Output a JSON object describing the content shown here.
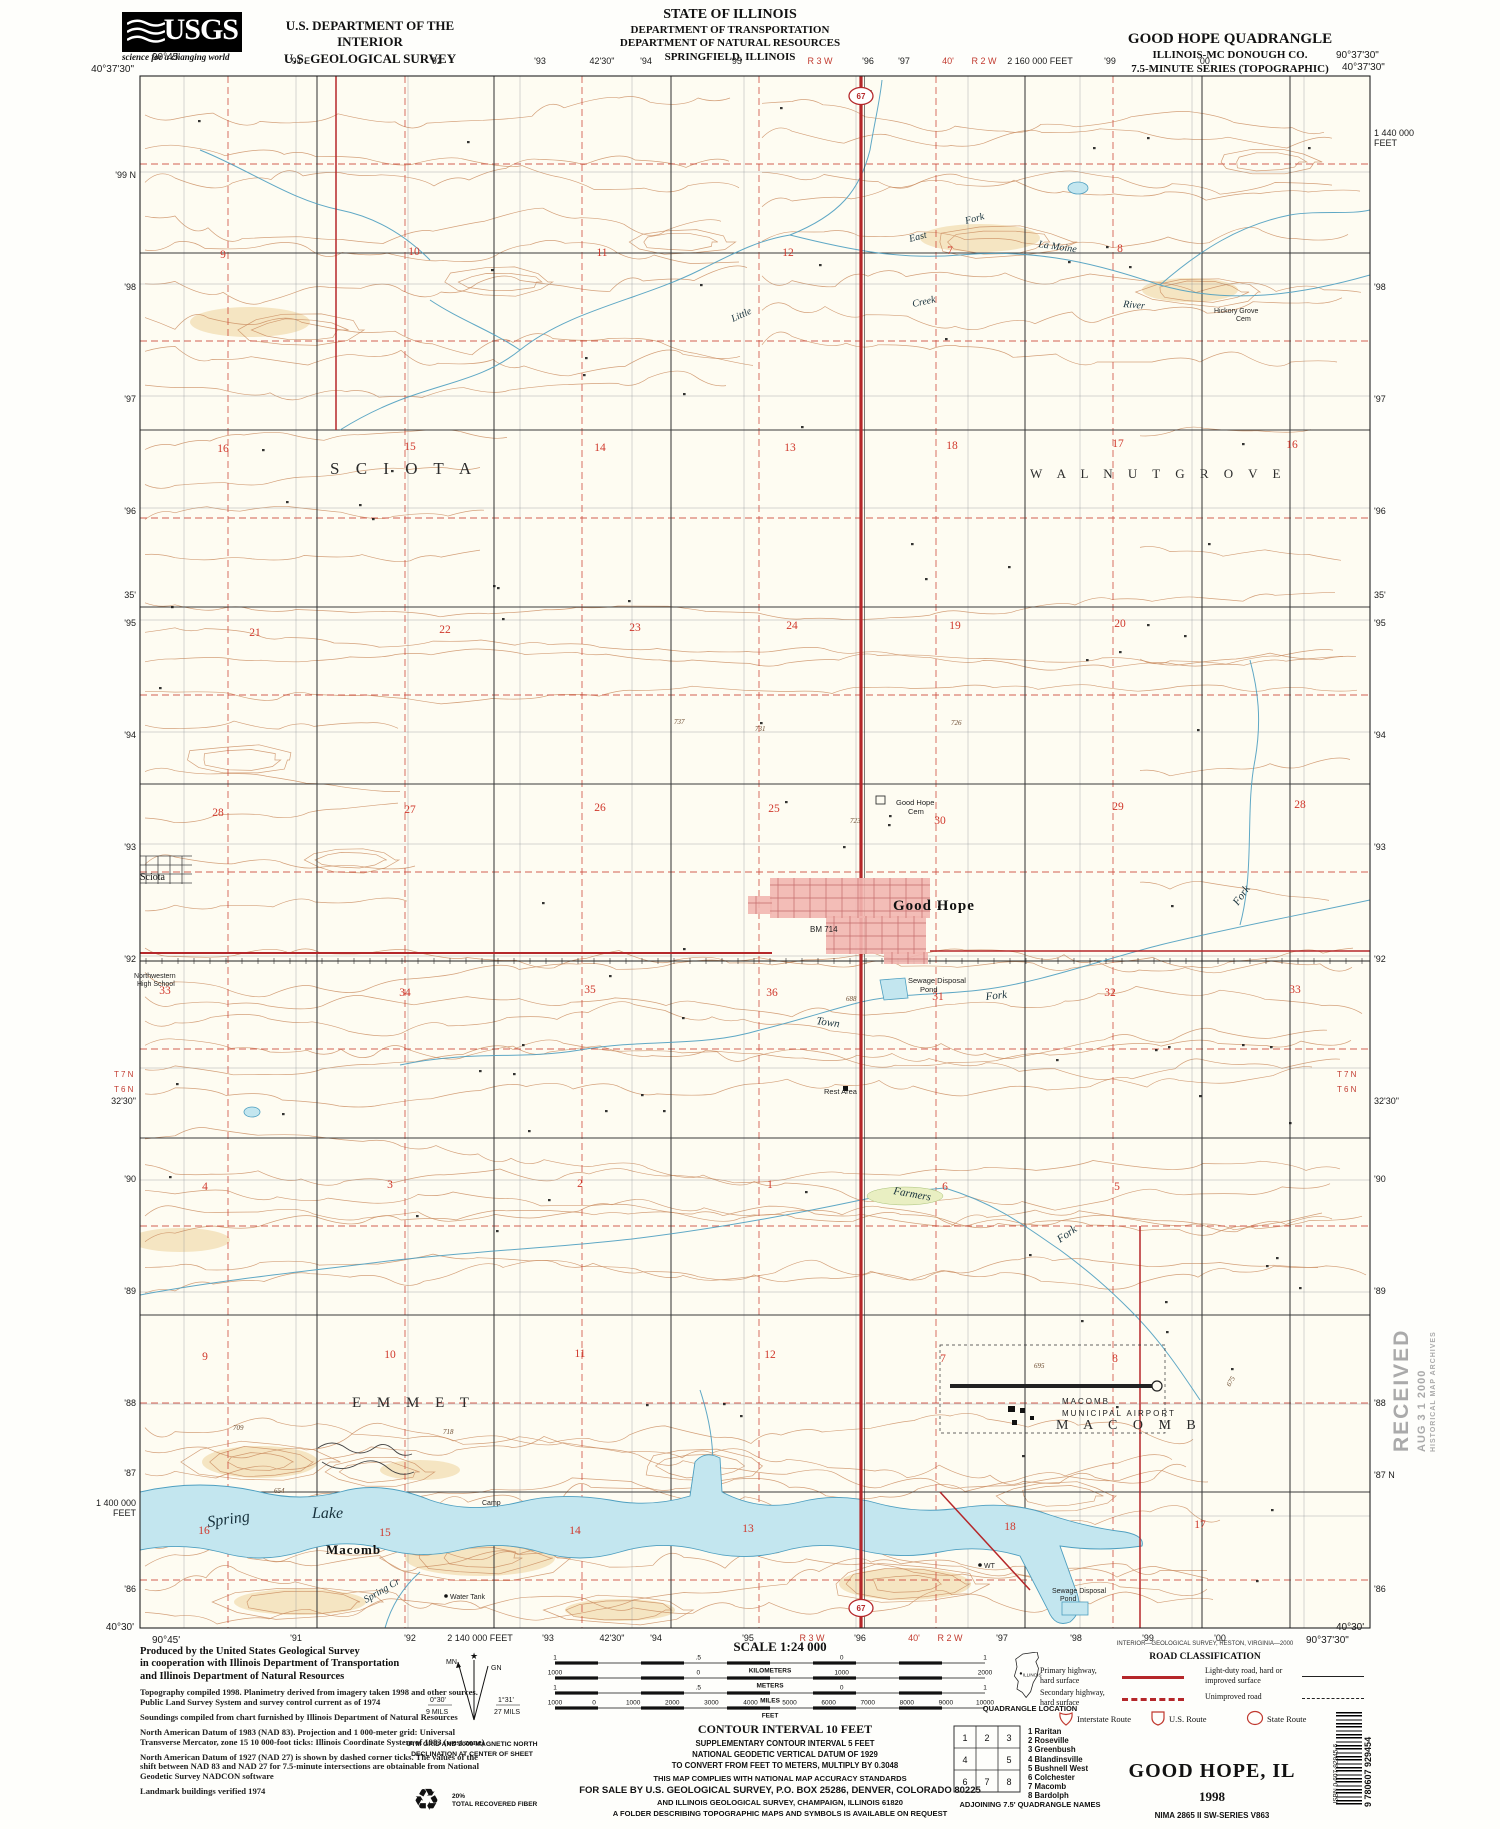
{
  "colors": {
    "primary_road": "#b5272a",
    "water_fill": "#c3e6ef",
    "water_line": "#4e9fc0",
    "contour": "#c9895c",
    "town_fill": "#f2b6b0",
    "section_red": "#d0382c"
  },
  "header": {
    "usgs": "USGS",
    "usgs_tagline": "science for a changing world",
    "agency_line1": "U.S. DEPARTMENT OF THE INTERIOR",
    "agency_line2": "U.S. GEOLOGICAL SURVEY",
    "state1": "STATE OF ILLINOIS",
    "state2": "DEPARTMENT OF TRANSPORTATION",
    "state3": "DEPARTMENT OF NATURAL RESOURCES",
    "state4": "SPRINGFIELD, ILLINOIS",
    "quad1": "GOOD HOPE QUADRANGLE",
    "quad2": "ILLINOIS-MC DONOUGH CO.",
    "quad3": "7.5-MINUTE SERIES (TOPOGRAPHIC)"
  },
  "map": {
    "corners": [
      {
        "t": "90°45'",
        "x": 152,
        "y": 60
      },
      {
        "t": "40°37'30\"",
        "x": 134,
        "y": 72,
        "a": "end"
      },
      {
        "t": "90°37'30\"",
        "x": 1336,
        "y": 58
      },
      {
        "t": "40°37'30\"",
        "x": 1342,
        "y": 70
      },
      {
        "t": "40°30'",
        "x": 134,
        "y": 1630,
        "a": "end"
      },
      {
        "t": "90°45'",
        "x": 152,
        "y": 1643
      },
      {
        "t": "40°30'",
        "x": 1336,
        "y": 1630
      },
      {
        "t": "90°37'30\"",
        "x": 1306,
        "y": 1643
      }
    ],
    "top_margin": [
      {
        "t": "'91 E",
        "x": 300
      },
      {
        "t": "'92",
        "x": 436
      },
      {
        "t": "'93",
        "x": 540
      },
      {
        "t": "42'30\"",
        "x": 602
      },
      {
        "t": "'94",
        "x": 646
      },
      {
        "t": "'95",
        "x": 736
      },
      {
        "t": "R 3 W",
        "x": 820,
        "c": "r"
      },
      {
        "t": "'96",
        "x": 868
      },
      {
        "t": "'97",
        "x": 904
      },
      {
        "t": "40'",
        "x": 948,
        "c": "r"
      },
      {
        "t": "R 2 W",
        "x": 984,
        "c": "r"
      },
      {
        "t": "2 160 000 FEET",
        "x": 1040,
        "s": 7.5
      },
      {
        "t": "'99",
        "x": 1110
      },
      {
        "t": "'00",
        "x": 1204
      }
    ],
    "bottom_margin": [
      {
        "t": "'91",
        "x": 296
      },
      {
        "t": "'92",
        "x": 410
      },
      {
        "t": "2 140 000 FEET",
        "x": 480,
        "s": 7.5
      },
      {
        "t": "'93",
        "x": 548
      },
      {
        "t": "42'30\"",
        "x": 612
      },
      {
        "t": "'94",
        "x": 656
      },
      {
        "t": "'95",
        "x": 748
      },
      {
        "t": "R 3 W",
        "x": 812,
        "c": "r"
      },
      {
        "t": "'96",
        "x": 860
      },
      {
        "t": "40'",
        "x": 914,
        "c": "r"
      },
      {
        "t": "R 2 W",
        "x": 950,
        "c": "r"
      },
      {
        "t": "'97",
        "x": 1002
      },
      {
        "t": "'98",
        "x": 1076
      },
      {
        "t": "'99",
        "x": 1148
      },
      {
        "t": "'00",
        "x": 1220
      }
    ],
    "left_margin": [
      {
        "t": "'99 N",
        "y": 178
      },
      {
        "t": "'98",
        "y": 290
      },
      {
        "t": "'97",
        "y": 402
      },
      {
        "t": "'96",
        "y": 514
      },
      {
        "t": "35'",
        "y": 598
      },
      {
        "t": "'95",
        "y": 626
      },
      {
        "t": "'94",
        "y": 738
      },
      {
        "t": "'93",
        "y": 850
      },
      {
        "t": "'92",
        "y": 962
      },
      {
        "t": "32'30\"",
        "y": 1104
      },
      {
        "t": "'90",
        "y": 1182
      },
      {
        "t": "'89",
        "y": 1294
      },
      {
        "t": "'88",
        "y": 1406
      },
      {
        "t": "'87",
        "y": 1476
      },
      {
        "t": "1 400 000",
        "y": 1506,
        "s": 7
      },
      {
        "t": "FEET",
        "y": 1516,
        "s": 7
      },
      {
        "t": "'86",
        "y": 1592
      }
    ],
    "right_margin": [
      {
        "t": "1 440 000",
        "y": 136,
        "s": 7
      },
      {
        "t": "FEET",
        "y": 146,
        "s": 7
      },
      {
        "t": "'98",
        "y": 290
      },
      {
        "t": "'97",
        "y": 402
      },
      {
        "t": "'96",
        "y": 514
      },
      {
        "t": "35'",
        "y": 598
      },
      {
        "t": "'95",
        "y": 626
      },
      {
        "t": "'94",
        "y": 738
      },
      {
        "t": "'93",
        "y": 850
      },
      {
        "t": "'92",
        "y": 962
      },
      {
        "t": "32'30\"",
        "y": 1104
      },
      {
        "t": "'90",
        "y": 1182
      },
      {
        "t": "'89",
        "y": 1294
      },
      {
        "t": "'88",
        "y": 1406
      },
      {
        "t": "'87 N",
        "y": 1478
      },
      {
        "t": "'86",
        "y": 1592
      }
    ],
    "labels": [
      {
        "t": "S C I O T A",
        "x": 330,
        "y": 474,
        "c": "twp",
        "s": 17
      },
      {
        "t": "W A L N U T   G R O V E",
        "x": 1030,
        "y": 478,
        "c": "twp",
        "s": 13
      },
      {
        "t": "E M M E T",
        "x": 352,
        "y": 1407,
        "c": "twp",
        "s": 15
      },
      {
        "t": "M A C O M B",
        "x": 1056,
        "y": 1429,
        "c": "twp",
        "s": 14
      },
      {
        "t": "Good Hope",
        "x": 893,
        "y": 910,
        "c": "town",
        "s": 15
      },
      {
        "t": "Sciota",
        "x": 140,
        "y": 880,
        "c": "ham",
        "s": 10
      },
      {
        "t": "Macomb",
        "x": 326,
        "y": 1554,
        "c": "town",
        "s": 13
      },
      {
        "t": "Spring",
        "x": 208,
        "y": 1527,
        "c": "wat",
        "s": 16,
        "r": -8
      },
      {
        "t": "Lake",
        "x": 312,
        "y": 1518,
        "c": "wat",
        "s": 16
      },
      {
        "t": "Little",
        "x": 733,
        "y": 322,
        "c": "wat",
        "s": 10,
        "r": -25
      },
      {
        "t": "East",
        "x": 910,
        "y": 242,
        "c": "wat",
        "s": 10,
        "r": -15
      },
      {
        "t": "Fork",
        "x": 966,
        "y": 224,
        "c": "wat",
        "s": 10,
        "r": -15
      },
      {
        "t": "La Moine",
        "x": 1038,
        "y": 247,
        "c": "wat",
        "s": 10,
        "r": 8
      },
      {
        "t": "Creek",
        "x": 913,
        "y": 307,
        "c": "wat",
        "s": 10,
        "r": -12
      },
      {
        "t": "River",
        "x": 1123,
        "y": 307,
        "c": "wat",
        "s": 10,
        "r": 5
      },
      {
        "t": "Hickory Grove",
        "x": 1214,
        "y": 313,
        "c": "ft",
        "s": 7
      },
      {
        "t": "Cem",
        "x": 1236,
        "y": 321,
        "c": "ft",
        "s": 7
      },
      {
        "t": "Town",
        "x": 816,
        "y": 1024,
        "c": "wat",
        "s": 11,
        "r": 8
      },
      {
        "t": "Fork",
        "x": 986,
        "y": 1000,
        "c": "wat",
        "s": 11,
        "r": -6
      },
      {
        "t": "Fork",
        "x": 1238,
        "y": 906,
        "c": "wat",
        "s": 11,
        "r": -55
      },
      {
        "t": "Farmers",
        "x": 893,
        "y": 1194,
        "c": "wat",
        "s": 11,
        "r": 10
      },
      {
        "t": "Fork",
        "x": 1060,
        "y": 1243,
        "c": "wat",
        "s": 11,
        "r": -35
      },
      {
        "t": "Spring Cr",
        "x": 366,
        "y": 1603,
        "c": "wat",
        "s": 10,
        "r": -30
      },
      {
        "t": "Good Hope",
        "x": 896,
        "y": 805,
        "c": "ft",
        "s": 7.5
      },
      {
        "t": "Cem",
        "x": 908,
        "y": 814,
        "c": "ft",
        "s": 7.5
      },
      {
        "t": "Sewage Disposal",
        "x": 908,
        "y": 983,
        "c": "ft",
        "s": 7.5
      },
      {
        "t": "Pond",
        "x": 920,
        "y": 992,
        "c": "ft",
        "s": 7.5
      },
      {
        "t": "Sewage Disposal",
        "x": 1052,
        "y": 1593,
        "c": "ft",
        "s": 7
      },
      {
        "t": "Pond",
        "x": 1060,
        "y": 1601,
        "c": "ft",
        "s": 7
      },
      {
        "t": "Rest Area",
        "x": 824,
        "y": 1094,
        "c": "ft",
        "s": 7.5
      },
      {
        "t": "Northwestern",
        "x": 134,
        "y": 978,
        "c": "ft",
        "s": 7
      },
      {
        "t": "High School",
        "x": 137,
        "y": 986,
        "c": "ft",
        "s": 7
      },
      {
        "t": "MACOMB",
        "x": 1062,
        "y": 1404,
        "c": "fts",
        "s": 8
      },
      {
        "t": "MUNICIPAL  AIRPORT",
        "x": 1062,
        "y": 1416,
        "c": "fts",
        "s": 8
      },
      {
        "t": "Water Tank",
        "x": 450,
        "y": 1599,
        "c": "ft",
        "s": 7
      },
      {
        "t": "Camp",
        "x": 482,
        "y": 1505,
        "c": "ft",
        "s": 7
      },
      {
        "t": "WT",
        "x": 984,
        "y": 1568,
        "c": "ft",
        "s": 7
      },
      {
        "t": "BM 714",
        "x": 810,
        "y": 932,
        "c": "ft",
        "s": 8
      },
      {
        "t": "688",
        "x": 846,
        "y": 1001,
        "c": "el",
        "s": 7
      },
      {
        "t": "654",
        "x": 274,
        "y": 1493,
        "c": "el",
        "s": 7
      },
      {
        "t": "695",
        "x": 1034,
        "y": 1368,
        "c": "el",
        "s": 7
      },
      {
        "t": "731",
        "x": 755,
        "y": 731,
        "c": "el",
        "s": 7
      },
      {
        "t": "737",
        "x": 674,
        "y": 724,
        "c": "el",
        "s": 7
      },
      {
        "t": "726",
        "x": 951,
        "y": 725,
        "c": "el",
        "s": 7
      },
      {
        "t": "718",
        "x": 443,
        "y": 1434,
        "c": "el",
        "s": 7
      },
      {
        "t": "709",
        "x": 233,
        "y": 1430,
        "c": "el",
        "s": 7
      },
      {
        "t": "675",
        "x": 1230,
        "y": 1387,
        "c": "el",
        "s": 7,
        "r": -60
      },
      {
        "t": "723",
        "x": 850,
        "y": 823,
        "c": "el",
        "s": 7
      },
      {
        "t": "T 7 N",
        "x": 114,
        "y": 1077,
        "c": "pl",
        "s": 8
      },
      {
        "t": "T 6 N",
        "x": 114,
        "y": 1092,
        "c": "pl",
        "s": 8
      },
      {
        "t": "T 7 N",
        "x": 1337,
        "y": 1077,
        "c": "pl",
        "s": 8
      },
      {
        "t": "T 6 N",
        "x": 1337,
        "y": 1092,
        "c": "pl",
        "s": 8
      }
    ],
    "sections": [
      {
        "n": "9",
        "x": 223,
        "y": 258
      },
      {
        "n": "10",
        "x": 414,
        "y": 255
      },
      {
        "n": "11",
        "x": 602,
        "y": 256
      },
      {
        "n": "12",
        "x": 788,
        "y": 256
      },
      {
        "n": "7",
        "x": 950,
        "y": 254
      },
      {
        "n": "8",
        "x": 1120,
        "y": 252
      },
      {
        "n": "16",
        "x": 223,
        "y": 452
      },
      {
        "n": "15",
        "x": 410,
        "y": 450
      },
      {
        "n": "14",
        "x": 600,
        "y": 451
      },
      {
        "n": "13",
        "x": 790,
        "y": 451
      },
      {
        "n": "18",
        "x": 952,
        "y": 449
      },
      {
        "n": "17",
        "x": 1118,
        "y": 447
      },
      {
        "n": "16",
        "x": 1292,
        "y": 448
      },
      {
        "n": "21",
        "x": 255,
        "y": 636
      },
      {
        "n": "22",
        "x": 445,
        "y": 633
      },
      {
        "n": "23",
        "x": 635,
        "y": 631
      },
      {
        "n": "24",
        "x": 792,
        "y": 629
      },
      {
        "n": "19",
        "x": 955,
        "y": 629
      },
      {
        "n": "20",
        "x": 1120,
        "y": 627
      },
      {
        "n": "28",
        "x": 218,
        "y": 816
      },
      {
        "n": "27",
        "x": 410,
        "y": 813
      },
      {
        "n": "26",
        "x": 600,
        "y": 811
      },
      {
        "n": "25",
        "x": 774,
        "y": 812
      },
      {
        "n": "30",
        "x": 940,
        "y": 824
      },
      {
        "n": "29",
        "x": 1118,
        "y": 810
      },
      {
        "n": "28",
        "x": 1300,
        "y": 808
      },
      {
        "n": "33",
        "x": 165,
        "y": 994
      },
      {
        "n": "34",
        "x": 405,
        "y": 996
      },
      {
        "n": "35",
        "x": 590,
        "y": 993
      },
      {
        "n": "36",
        "x": 772,
        "y": 996
      },
      {
        "n": "31",
        "x": 938,
        "y": 1000
      },
      {
        "n": "32",
        "x": 1110,
        "y": 996
      },
      {
        "n": "33",
        "x": 1295,
        "y": 993
      },
      {
        "n": "4",
        "x": 205,
        "y": 1190
      },
      {
        "n": "3",
        "x": 390,
        "y": 1188
      },
      {
        "n": "2",
        "x": 580,
        "y": 1187
      },
      {
        "n": "1",
        "x": 770,
        "y": 1188
      },
      {
        "n": "6",
        "x": 945,
        "y": 1190
      },
      {
        "n": "5",
        "x": 1117,
        "y": 1190
      },
      {
        "n": "9",
        "x": 205,
        "y": 1360
      },
      {
        "n": "10",
        "x": 390,
        "y": 1358
      },
      {
        "n": "11",
        "x": 580,
        "y": 1357
      },
      {
        "n": "12",
        "x": 770,
        "y": 1358
      },
      {
        "n": "7",
        "x": 943,
        "y": 1362
      },
      {
        "n": "8",
        "x": 1115,
        "y": 1362
      },
      {
        "n": "16",
        "x": 204,
        "y": 1534
      },
      {
        "n": "15",
        "x": 385,
        "y": 1536
      },
      {
        "n": "14",
        "x": 575,
        "y": 1534
      },
      {
        "n": "13",
        "x": 748,
        "y": 1532
      },
      {
        "n": "18",
        "x": 1010,
        "y": 1530
      },
      {
        "n": "17",
        "x": 1200,
        "y": 1528
      }
    ],
    "shields": [
      {
        "n": "67",
        "x": 861,
        "y": 96
      },
      {
        "n": "67",
        "x": 861,
        "y": 1608
      }
    ]
  },
  "footer": {
    "credits": {
      "bold": [
        "Produced by the United States Geological Survey",
        "in cooperation with Illinois Department of Transportation",
        "and Illinois Department of Natural Resources"
      ],
      "paras": [
        "Topography compiled 1998.  Planimetry derived from imagery taken 1998 and other sources.  Public Land Survey System and survey control current as of 1974",
        "Soundings compiled from chart furnished by Illinois Department of Natural Resources",
        "North American Datum of 1983 (NAD 83).  Projection and 1 000-meter grid: Universal Transverse Mercator, zone 15 10 000-foot ticks: Illinois Coordinate System of 1983 (west zone)",
        "North American Datum of 1927 (NAD 27) is shown by dashed corner ticks.  The values of the shift between NAD 83 and NAD 27 for 7.5-minute intersections are obtainable from National Geodetic Survey NADCON software",
        "Landmark buildings verified 1974"
      ]
    },
    "declination": {
      "mn": "MN",
      "gn": "GN",
      "star": "★",
      "mn_deg": "0°30'",
      "mn_mils": "9 MILS",
      "gn_deg": "1°31'",
      "gn_mils": "27 MILS",
      "caption1": "UTM GRID AND 2000 MAGNETIC NORTH",
      "caption2": "DECLINATION AT CENTER OF SHEET"
    },
    "recycle": {
      "icon": "♻",
      "pct": "20%",
      "label": "TOTAL RECOVERED FIBER"
    },
    "scale": {
      "title": "SCALE 1:24 000",
      "bars": [
        {
          "unit": "KILOMETERS",
          "labels": [
            "1",
            ".5",
            "0",
            "1"
          ]
        },
        {
          "unit": "METERS",
          "labels": [
            "1000",
            "0",
            "1000",
            "2000"
          ]
        },
        {
          "unit": "MILES",
          "labels": [
            "1",
            ".5",
            "0",
            "1"
          ]
        },
        {
          "unit": "FEET",
          "labels": [
            "1000",
            "0",
            "1000",
            "2000",
            "3000",
            "4000",
            "5000",
            "6000",
            "7000",
            "8000",
            "9000",
            "10000"
          ]
        }
      ]
    },
    "contour": [
      "CONTOUR INTERVAL 10 FEET",
      "SUPPLEMENTARY CONTOUR INTERVAL 5 FEET",
      "NATIONAL GEODETIC VERTICAL DATUM OF 1929",
      "TO CONVERT FROM FEET TO METERS, MULTIPLY BY 0.3048"
    ],
    "compliance": [
      "THIS MAP COMPLIES WITH NATIONAL MAP ACCURACY STANDARDS",
      "FOR SALE BY U.S. GEOLOGICAL SURVEY, P.O. BOX 25286, DENVER, COLORADO 80225",
      "AND ILLINOIS GEOLOGICAL SURVEY, CHAMPAIGN, ILLINOIS 61820",
      "A FOLDER DESCRIBING TOPOGRAPHIC MAPS AND SYMBOLS IS AVAILABLE ON REQUEST"
    ],
    "quad_location": {
      "state": "ILLINOIS",
      "caption": "QUADRANGLE LOCATION"
    },
    "adjoining": {
      "cells": [
        "1",
        "2",
        "3",
        "4",
        "",
        "5",
        "6",
        "7",
        "8"
      ],
      "names": [
        "1 Raritan",
        "2 Roseville",
        "3 Greenbush",
        "4 Blandinsville",
        "5 Bushnell West",
        "6 Colchester",
        "7 Macomb",
        "8 Bardolph"
      ],
      "caption": "ADJOINING 7.5' QUADRANGLE NAMES"
    },
    "road_class": {
      "survey_credit": "INTERIOR—GEOLOGICAL SURVEY, RESTON, VIRGINIA—2000",
      "title": "ROAD CLASSIFICATION",
      "left_rows": [
        {
          "l1": "Primary highway,",
          "l2": "hard surface"
        },
        {
          "l1": "Secondary highway,",
          "l2": "hard surface"
        }
      ],
      "right_rows": [
        {
          "l1": "Light-duty road, hard or",
          "l2": "improved surface"
        },
        {
          "l1": "Unimproved road",
          "l2": ""
        }
      ],
      "shields": [
        "Interstate Route",
        "U.S. Route",
        "State Route"
      ]
    },
    "publisher": {
      "title": "GOOD HOPE, IL",
      "year": "1998",
      "series": "NIMA 2865 II SW-SERIES V863"
    },
    "barcode": {
      "isbn": "ISBN 0-607-92945-6",
      "digits": "9 780607 929454"
    },
    "stamp": {
      "l1": "RECEIVED",
      "l2": "AUG 3 1 2000",
      "l3": "HISTORICAL MAP ARCHIVES"
    }
  }
}
